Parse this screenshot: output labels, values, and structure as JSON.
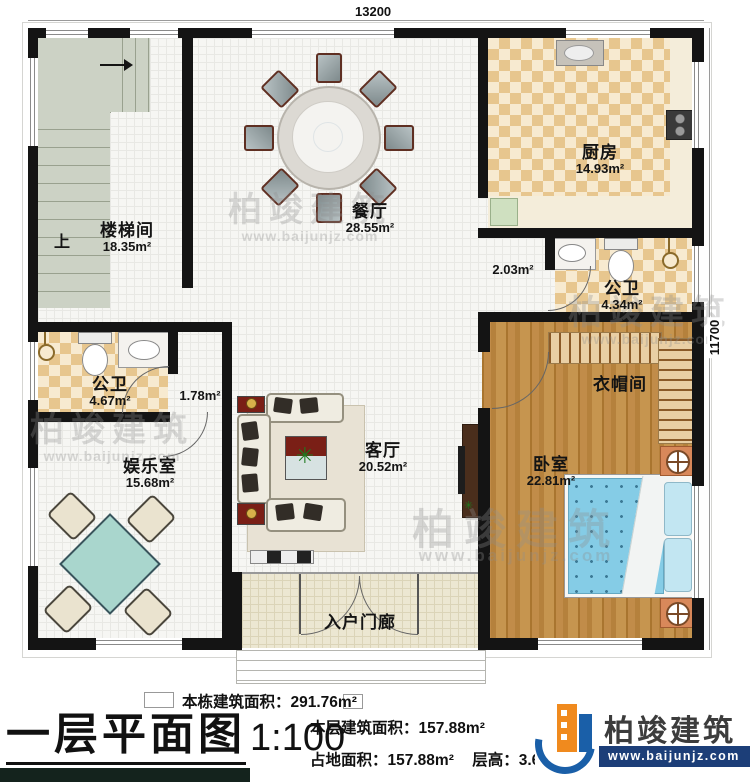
{
  "plan": {
    "dimensions": {
      "top": "13200",
      "right": "11700"
    },
    "rooms": {
      "stairwell": {
        "name": "楼梯间",
        "area": "18.35m²"
      },
      "dining": {
        "name": "餐厅",
        "area": "28.55m²"
      },
      "kitchen": {
        "name": "厨房",
        "area": "14.93m²"
      },
      "bath_right": {
        "name": "公卫",
        "area": "4.34m²"
      },
      "bath_left": {
        "name": "公卫",
        "area": "4.67m²"
      },
      "entertainment": {
        "name": "娱乐室",
        "area": "15.68m²"
      },
      "living": {
        "name": "客厅",
        "area": "20.52m²"
      },
      "bedroom": {
        "name": "卧室",
        "area": "22.81m²"
      },
      "cloakroom": {
        "name": "衣帽间"
      },
      "porch": {
        "name": "入户门廊"
      }
    },
    "annotations": {
      "up": "上",
      "corridor_area": "2.03m²",
      "closet_area": "1.78m²"
    }
  },
  "title_block": {
    "title": "一层平面图",
    "scale": "1:100",
    "stats": [
      {
        "label": "本栋建筑面积：",
        "value": "291.76m²"
      },
      {
        "label": "本层建筑面积：",
        "value": "157.88m²"
      },
      {
        "label": "占地面积：",
        "value": "157.88m²"
      },
      {
        "label": "层高：",
        "value": "3.6m"
      }
    ]
  },
  "brand": {
    "name": "柏竣建筑",
    "website": "www.baijunjz.com"
  },
  "watermark": {
    "line1": "柏竣建筑",
    "line2": "www.baijunjz.com"
  },
  "colors": {
    "wall": "#141414",
    "checker_dark": "#e7c68e",
    "checker_light": "#f7ead0",
    "wood": "#b5813c",
    "stair": "#ccd2c5",
    "bed_blue": "#85cce6",
    "brand_blue": "#1c3e78",
    "brand_orange": "#f08a1e"
  }
}
